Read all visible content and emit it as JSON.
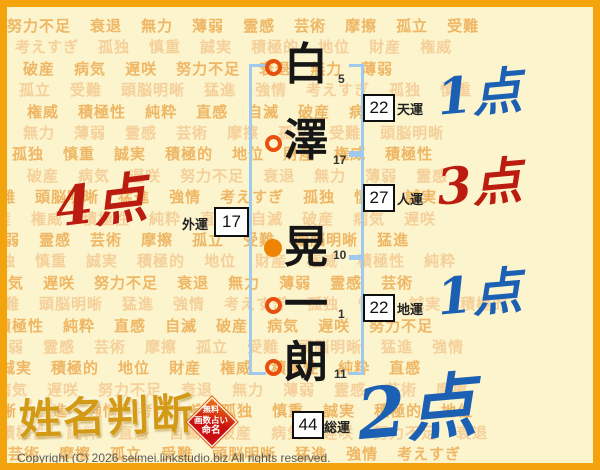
{
  "page": {
    "copyright": "Copyright (C) 2026 seimei.linkstudio.biz All rights reserved."
  },
  "logo": {
    "title": "姓名判断",
    "seal_lines": [
      "無料",
      "画数占い",
      "命名"
    ]
  },
  "name": {
    "characters": [
      {
        "char": "白",
        "strokes": "5",
        "marker": "ring"
      },
      {
        "char": "澤",
        "strokes": "17",
        "marker": "ring"
      },
      {
        "char": "晃",
        "strokes": "10",
        "marker": "filled"
      },
      {
        "char": "一",
        "strokes": "1",
        "marker": "ring"
      },
      {
        "char": "朗",
        "strokes": "11",
        "marker": "ring"
      }
    ]
  },
  "results": [
    {
      "id": "tenun",
      "label": "天運",
      "value": "22",
      "score": "1点",
      "score_color": "blue"
    },
    {
      "id": "jinun",
      "label": "人運",
      "value": "27",
      "score": "3点",
      "score_color": "red"
    },
    {
      "id": "chiun",
      "label": "地運",
      "value": "22",
      "score": "1点",
      "score_color": "blue"
    },
    {
      "id": "gaiun",
      "label": "外運",
      "value": "17",
      "score": "4点",
      "score_color": "red"
    },
    {
      "id": "soun",
      "label": "総運",
      "value": "44",
      "score": "2点",
      "score_color": "blue"
    }
  ],
  "colors": {
    "frame": "#f3a30c",
    "background": "#fbf4cd",
    "bracket": "#9fc9ee",
    "ring": "#e8500d",
    "filled_dot": "#ee8403",
    "score_red": "#bb1c0f",
    "score_blue": "#1c60b4",
    "seal_red": "#c90f0f",
    "logo_gold": "#d29a15"
  },
  "background": {
    "words": [
      "努力不足",
      "衰退",
      "無力",
      "薄弱",
      "霊感",
      "芸術",
      "摩擦",
      "孤立",
      "受難",
      "頭脳明晰",
      "猛進",
      "強情",
      "考えすぎ",
      "孤独",
      "慎重",
      "誠実",
      "積極的",
      "地位",
      "財産",
      "権威",
      "積極性",
      "純粋",
      "直感",
      "自滅",
      "破産",
      "病気",
      "遅咲"
    ]
  }
}
